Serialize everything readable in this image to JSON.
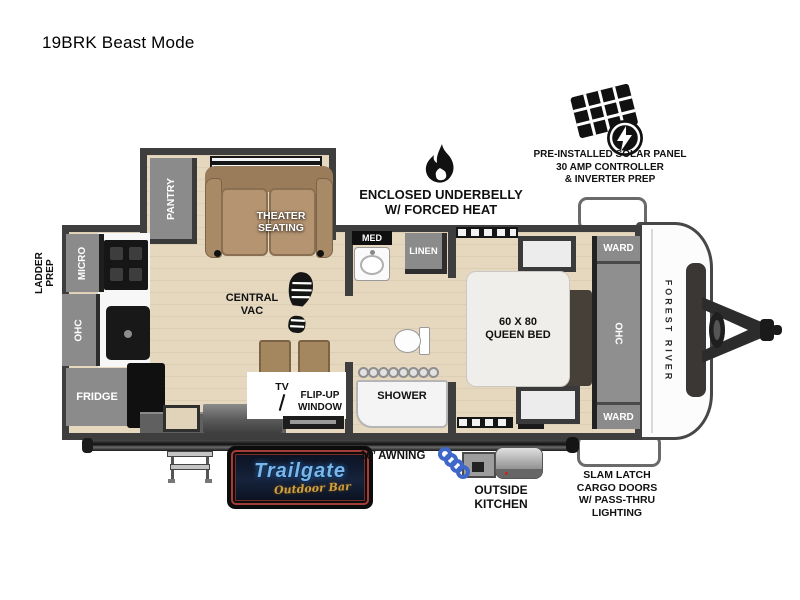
{
  "title": "19BRK Beast Mode",
  "callouts": {
    "underbelly": {
      "lines": [
        "ENCLOSED UNDERBELLY",
        "W/ FORCED HEAT"
      ]
    },
    "solar": {
      "lines": [
        "PRE-INSTALLED SOLAR PANEL",
        "30 AMP CONTROLLER",
        "& INVERTER PREP"
      ]
    }
  },
  "floorplan": {
    "ladder_prep_lines": [
      "LADDER",
      "PREP"
    ],
    "pantry": "PANTRY",
    "theater_lines": [
      "THEATER",
      "SEATING"
    ],
    "micro": "MICRO",
    "kitchen_ohc": "OHC",
    "fridge": "FRIDGE",
    "central_vac_lines": [
      "CENTRAL",
      "VAC"
    ],
    "tv": "TV",
    "flip_up_window_lines": [
      "FLIP-UP",
      "WINDOW"
    ],
    "med": "MED",
    "linen": "LINEN",
    "shower": "SHOWER",
    "queen_bed_lines": [
      "60 X 80",
      "QUEEN BED"
    ],
    "ward_top": "WARD",
    "bedroom_ohc": "OHC",
    "ward_bottom": "WARD",
    "brand": "FOREST RIVER"
  },
  "exterior": {
    "awning": "16’ AWNING",
    "outside_kitchen_lines": [
      "OUTSIDE",
      "KITCHEN"
    ],
    "cargo_lines": [
      "SLAM LATCH",
      "CARGO DOORS",
      "W/ PASS-THRU",
      "LIGHTING"
    ]
  },
  "logo": {
    "name": "Trailgate",
    "subtitle": "Outdoor Bar"
  },
  "colors": {
    "wall": "#3e3e3e",
    "floor": "#e5d8bf",
    "cabinet": "#8b8b8b",
    "sofa": "#ab8c69",
    "logo_blue": "#7ab6ea",
    "logo_gold": "#cfa13f",
    "hose_blue": "#3f67c9"
  }
}
